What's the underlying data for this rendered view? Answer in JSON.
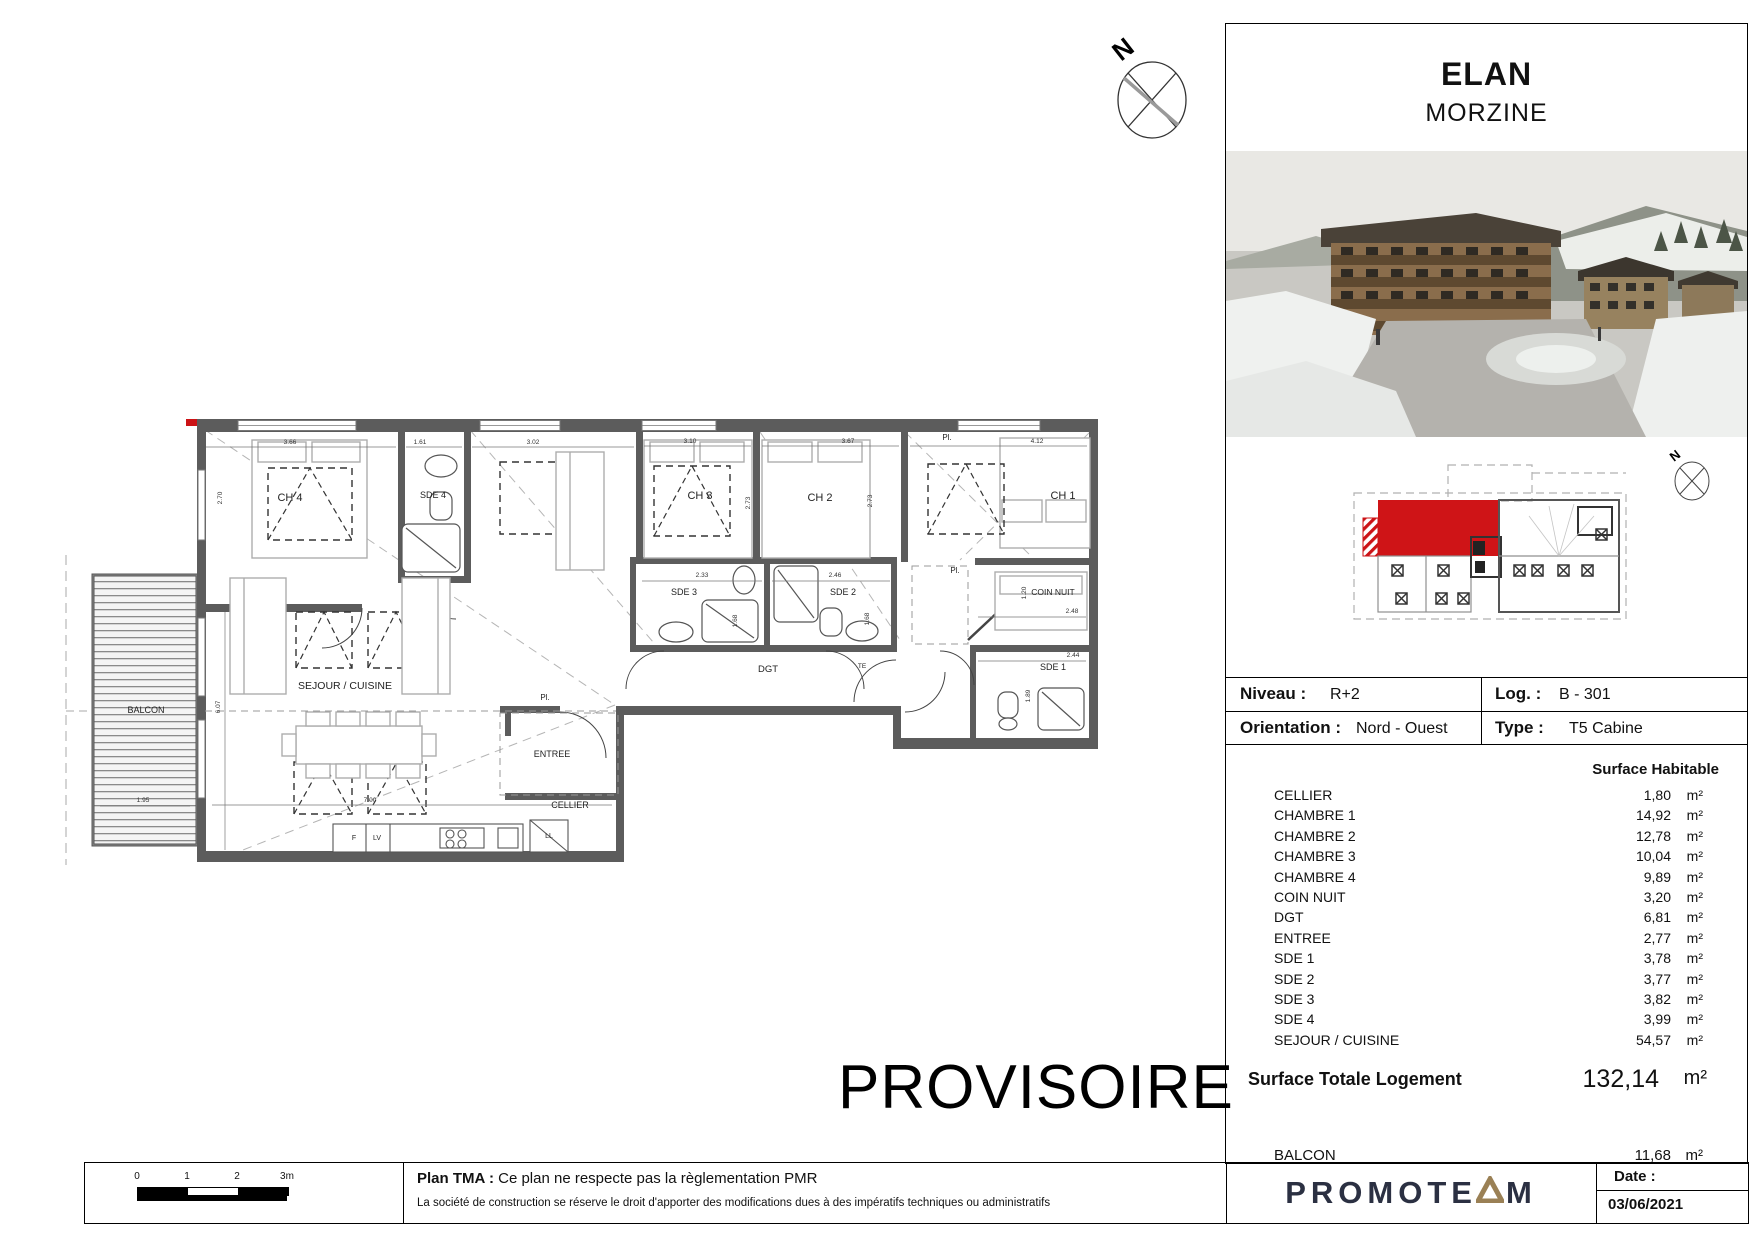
{
  "title": {
    "project": "ELAN",
    "location": "MORZINE"
  },
  "north_label": "N",
  "info_table": {
    "niveau_label": "Niveau :",
    "niveau_value": "R+2",
    "log_label": "Log. :",
    "log_value": "B - 301",
    "orientation_label": "Orientation :",
    "orientation_value": "Nord - Ouest",
    "type_label": "Type :",
    "type_value": "T5 Cabine"
  },
  "surfaces": {
    "header": "Surface Habitable",
    "unit": "m²",
    "rows": [
      {
        "name": "CELLIER",
        "value": "1,80"
      },
      {
        "name": "CHAMBRE 1",
        "value": "14,92"
      },
      {
        "name": "CHAMBRE 2",
        "value": "12,78"
      },
      {
        "name": "CHAMBRE 3",
        "value": "10,04"
      },
      {
        "name": "CHAMBRE 4",
        "value": "9,89"
      },
      {
        "name": "COIN NUIT",
        "value": "3,20"
      },
      {
        "name": "DGT",
        "value": "6,81"
      },
      {
        "name": "ENTREE",
        "value": "2,77"
      },
      {
        "name": "SDE 1",
        "value": "3,78"
      },
      {
        "name": "SDE 2",
        "value": "3,77"
      },
      {
        "name": "SDE 3",
        "value": "3,82"
      },
      {
        "name": "SDE 4",
        "value": "3,99"
      },
      {
        "name": "SEJOUR / CUISINE",
        "value": "54,57"
      }
    ],
    "total_label": "Surface Totale Logement",
    "total_value": "132,14",
    "balcon_label": "BALCON",
    "balcon_value": "11,68"
  },
  "watermark": "PROVISOIRE",
  "footer": {
    "scale_ticks": [
      "0",
      "1",
      "2",
      "3m"
    ],
    "plan_tma_bold": "Plan TMA :",
    "plan_tma_text": "Ce plan ne respecte pas la règlementation PMR",
    "disclaimer": "La société de construction se réserve le droit d'apporter des modifications dues à des impératifs techniques ou administratifs",
    "brand_prefix": "PROMOTE",
    "brand_suffix": "M",
    "date_label": "Date :",
    "date_value": "03/06/2021"
  },
  "plan": {
    "rooms": [
      {
        "text": "CH 4",
        "x": 290,
        "y": 501,
        "s": 11
      },
      {
        "text": "SDE 4",
        "x": 433,
        "y": 498,
        "s": 9
      },
      {
        "text": "CH 3",
        "x": 700,
        "y": 499,
        "s": 11
      },
      {
        "text": "CH 2",
        "x": 820,
        "y": 501,
        "s": 11
      },
      {
        "text": "CH 1",
        "x": 1063,
        "y": 499,
        "s": 11
      },
      {
        "text": "SDE 3",
        "x": 684,
        "y": 595,
        "s": 9
      },
      {
        "text": "SDE 2",
        "x": 843,
        "y": 595,
        "s": 9
      },
      {
        "text": "COIN NUIT",
        "x": 1053,
        "y": 595,
        "s": 8.5
      },
      {
        "text": "SDE 1",
        "x": 1053,
        "y": 670,
        "s": 9
      },
      {
        "text": "DGT",
        "x": 768,
        "y": 672,
        "s": 9.5
      },
      {
        "text": "TE",
        "x": 862,
        "y": 668,
        "s": 6.5
      },
      {
        "text": "SEJOUR / CUISINE",
        "x": 345,
        "y": 689,
        "s": 10.5
      },
      {
        "text": "ENTREE",
        "x": 552,
        "y": 757,
        "s": 9
      },
      {
        "text": "CELLIER",
        "x": 570,
        "y": 808,
        "s": 9
      },
      {
        "text": "BALCON",
        "x": 146,
        "y": 713,
        "s": 9
      },
      {
        "text": "Pl.",
        "x": 947,
        "y": 440,
        "s": 8
      },
      {
        "text": "Pl.",
        "x": 955,
        "y": 573,
        "s": 8
      },
      {
        "text": "Pl.",
        "x": 545,
        "y": 700,
        "s": 8
      },
      {
        "text": "F",
        "x": 354,
        "y": 840,
        "s": 7
      },
      {
        "text": "LV",
        "x": 377,
        "y": 840,
        "s": 7
      },
      {
        "text": "LL",
        "x": 549,
        "y": 838,
        "s": 7
      }
    ],
    "dims": [
      {
        "text": "3.66",
        "x": 290,
        "y": 444,
        "r": 0
      },
      {
        "text": "1.61",
        "x": 420,
        "y": 444,
        "r": 0
      },
      {
        "text": "3.02",
        "x": 533,
        "y": 444,
        "r": 0
      },
      {
        "text": "3.10",
        "x": 690,
        "y": 443,
        "r": 0
      },
      {
        "text": "3.67",
        "x": 848,
        "y": 443,
        "r": 0
      },
      {
        "text": "4.12",
        "x": 1037,
        "y": 443,
        "r": 0
      },
      {
        "text": "2.70",
        "x": 222,
        "y": 498,
        "r": -90
      },
      {
        "text": "2.73",
        "x": 750,
        "y": 503,
        "r": -90
      },
      {
        "text": "2.73",
        "x": 872,
        "y": 501,
        "r": -90
      },
      {
        "text": "2.33",
        "x": 702,
        "y": 577,
        "r": 0
      },
      {
        "text": "2.46",
        "x": 835,
        "y": 577,
        "r": 0
      },
      {
        "text": "2.48",
        "x": 1072,
        "y": 613,
        "r": 0
      },
      {
        "text": "2.44",
        "x": 1073,
        "y": 657,
        "r": 0
      },
      {
        "text": "1.89",
        "x": 1030,
        "y": 696,
        "r": -90
      },
      {
        "text": "1.20",
        "x": 1026,
        "y": 593,
        "r": -90
      },
      {
        "text": "1.68",
        "x": 737,
        "y": 621,
        "r": -90
      },
      {
        "text": "1.68",
        "x": 869,
        "y": 619,
        "r": -90
      },
      {
        "text": "6.07",
        "x": 220,
        "y": 707,
        "r": -90
      },
      {
        "text": "7.00",
        "x": 370,
        "y": 802,
        "r": 0
      },
      {
        "text": "1.95",
        "x": 143,
        "y": 802,
        "r": 0
      }
    ]
  },
  "colors": {
    "accent_red": "#cc1316",
    "brand_navy": "#2b3042",
    "brand_gold": "#9a8055",
    "wall_gray": "#5c5c5c"
  }
}
